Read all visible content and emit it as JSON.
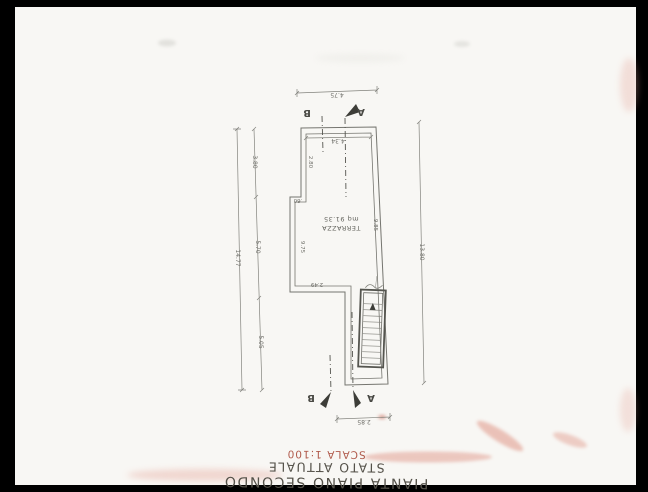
{
  "scan": {
    "border_color": "#000000",
    "paper_color": "#f8f7f4",
    "line_color": "#6e6e68",
    "artifact_pink": "#e0988a",
    "orientation_note": "drawing scanned rotated 180 degrees"
  },
  "title_block": {
    "line1": "PIANTA PIANO SECONDO",
    "line2": "STATO ATTUALE",
    "line3": "SCALA 1:100",
    "scala_color": "#b05a4b",
    "text_color": "#55524a"
  },
  "plan": {
    "room_label": "TERRAZZA",
    "room_area": "mq 91.35",
    "sections": {
      "a": "A",
      "b": "B"
    },
    "dimensions": {
      "top_outer": "4.75",
      "top_inner": "4.34",
      "left_total": "14.77",
      "left_seg1": "3.80",
      "left_seg2": "5.70",
      "left_seg3": "5.05",
      "right_total": "13.80",
      "jog": ".60",
      "inner_left_upper": "2.80",
      "inner_left": "9.75",
      "inner_right": "9.85",
      "bottom_left_wall": "2.49",
      "bottom": "2.85"
    }
  }
}
